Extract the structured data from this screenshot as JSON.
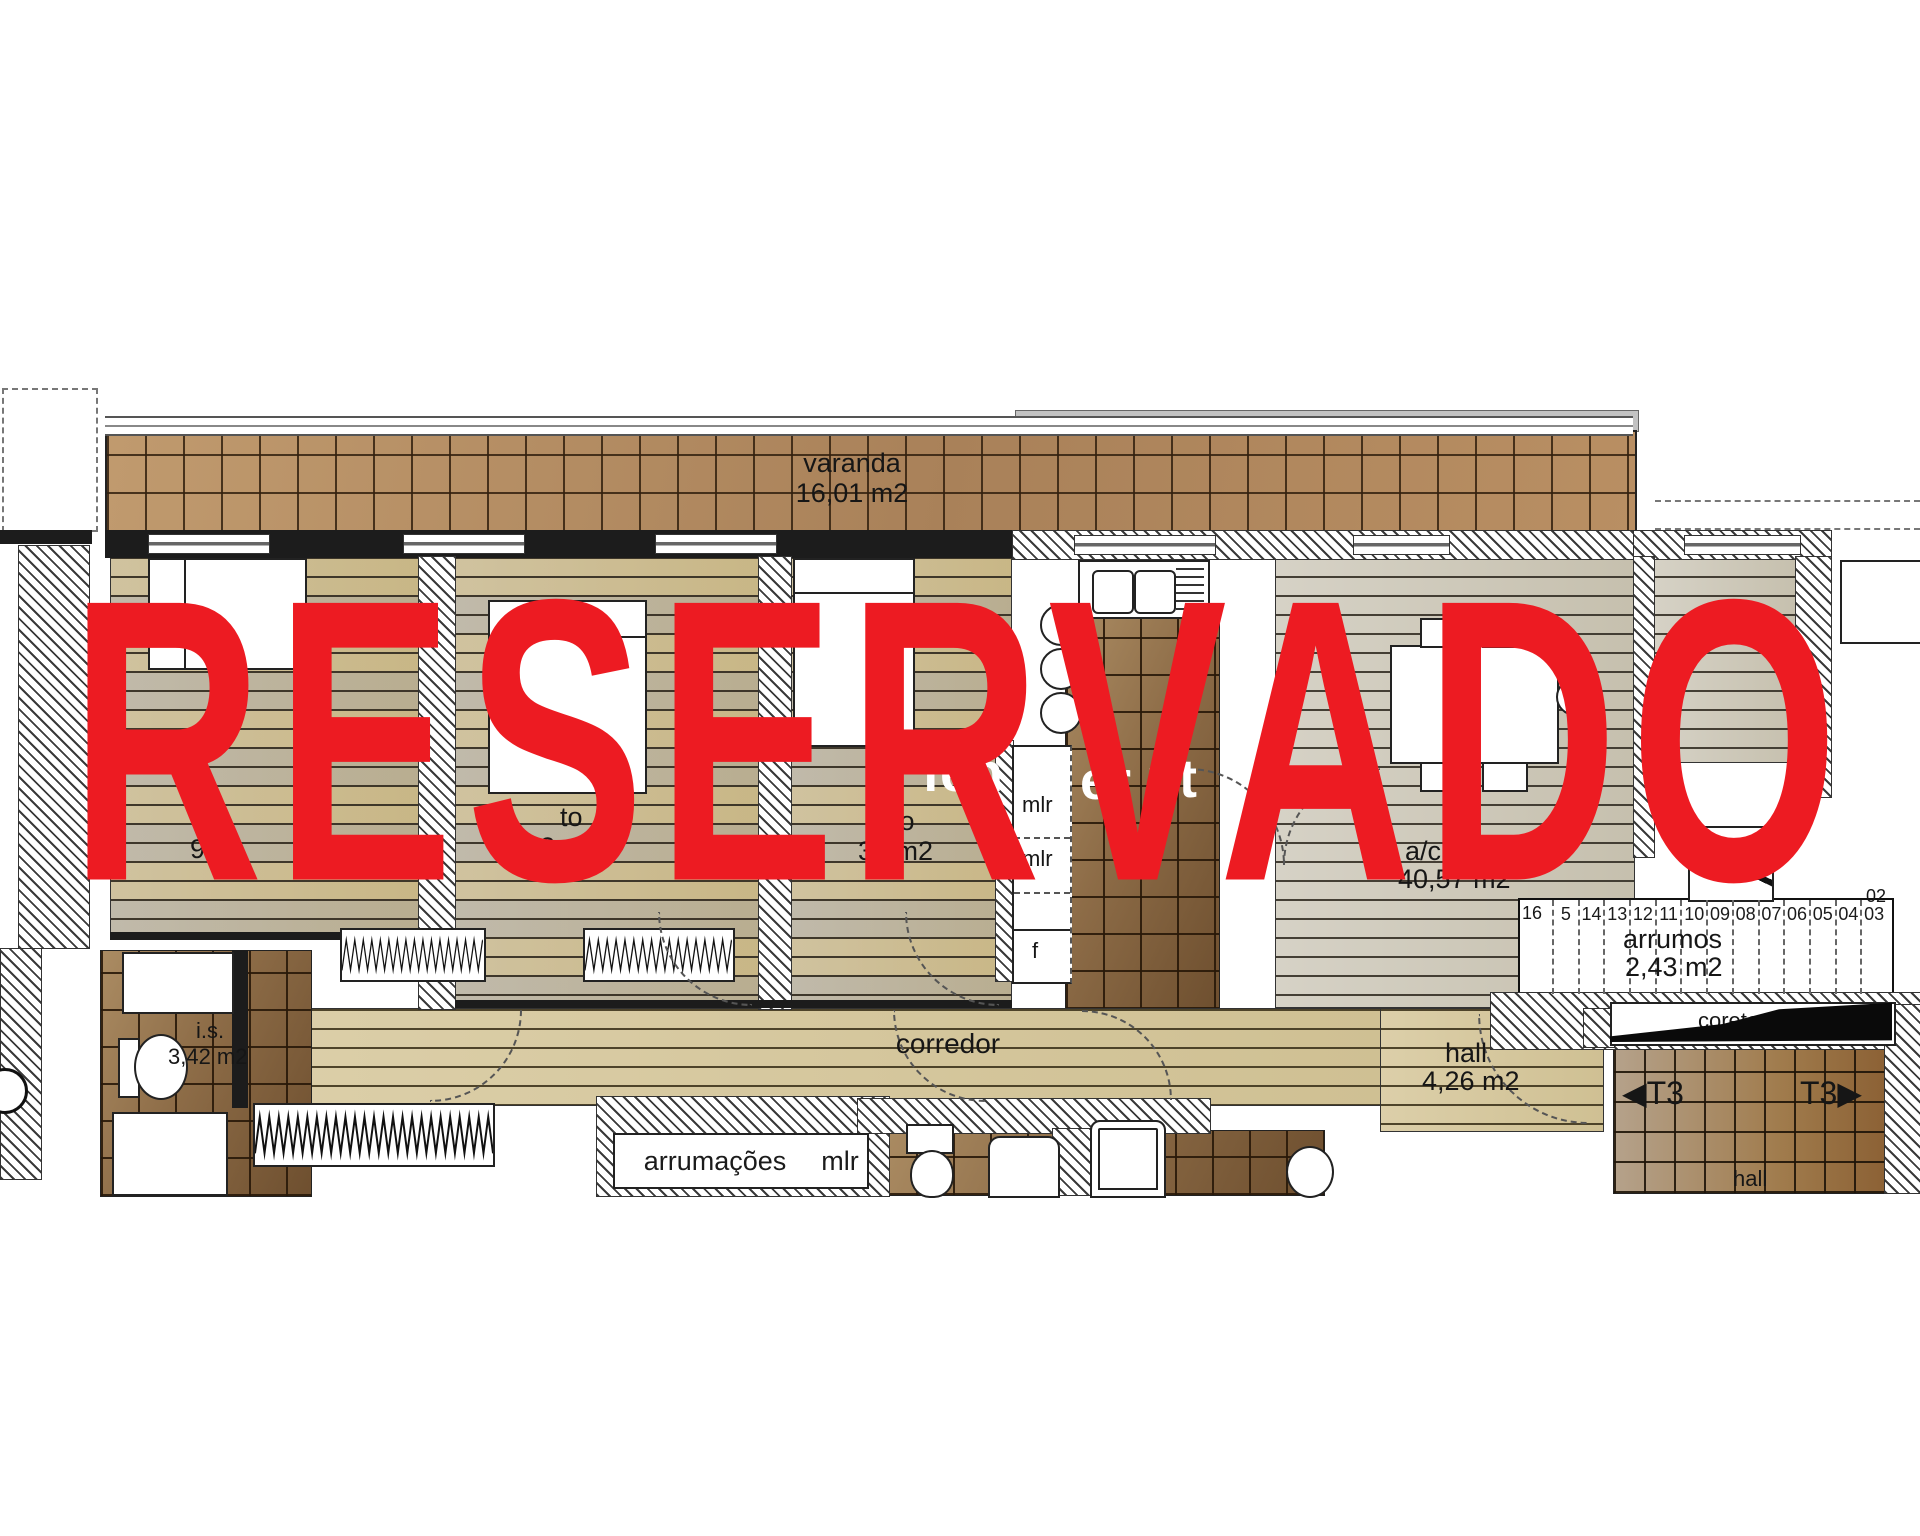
{
  "watermark": {
    "text": "RESERVADO",
    "color": "#ed1b22"
  },
  "site_watermark": {
    "frag_feh": "feh",
    "frag_er": "er",
    "frag_pt": "pt"
  },
  "rooms": {
    "varanda_label": "varanda",
    "varanda_area": "16,01 m2",
    "quarto1_area_fragment": "9,03",
    "quarto2_label_fragment": "to",
    "quarto2_area_fragment": "3 m2",
    "quarto3_label_fragment": "arto",
    "quarto3_area_fragment": "33 m2",
    "sala_label_fragment": "a/c",
    "sala_area": "40,57 m2",
    "corredor_label": "corredor",
    "hall_label": "hall",
    "hall_area": "4,26 m2",
    "arrumos_label": "arrumos",
    "arrumos_area": "2,43 m2",
    "is_label": "i.s.",
    "is_area": "3,42 m2",
    "arrumacoes_label": "arrumações",
    "mlr_label": "mlr",
    "closet_mlr1": "mlr",
    "closet_mlr2": "mlr",
    "closet_f": "f",
    "stair_hall_label": "hall",
    "corete_fragment": "corete ge"
  },
  "stairs": {
    "numbers": [
      "16",
      "5",
      "14",
      "13",
      "12",
      "11",
      "10",
      "09",
      "08",
      "07",
      "06",
      "05",
      "04",
      "03"
    ],
    "top_number": "02"
  },
  "unit_markers": {
    "label_left": "T3",
    "label_right": "T3",
    "arrow_left": "◀",
    "arrow_right": "▶"
  }
}
